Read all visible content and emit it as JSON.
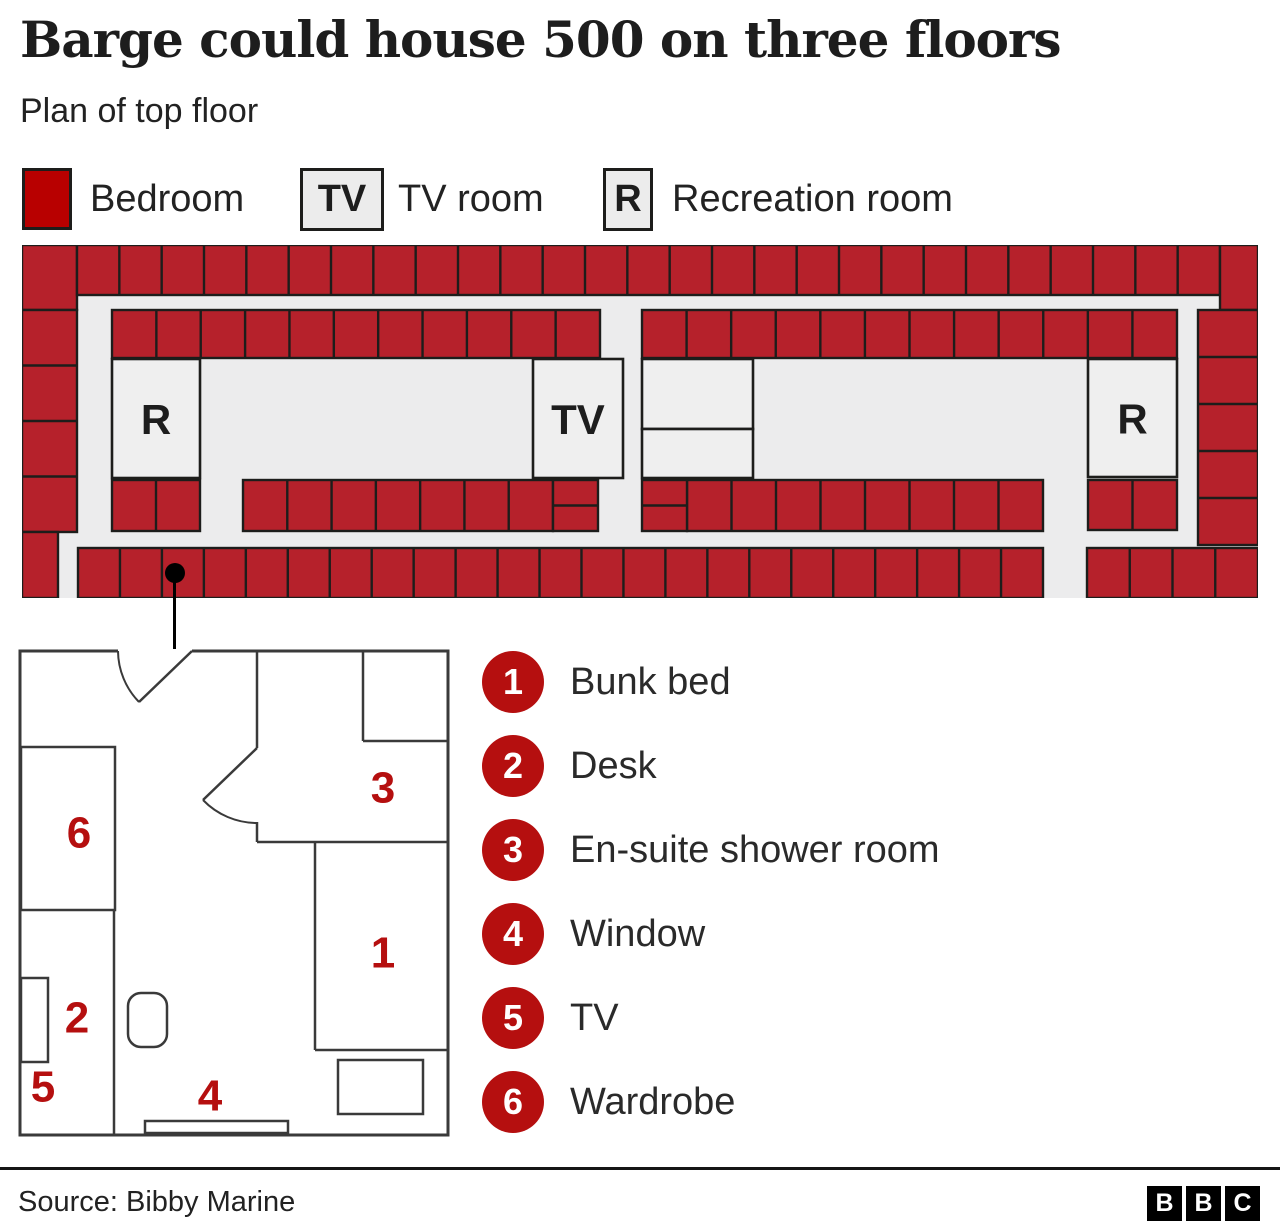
{
  "title": "Barge could house 500 on three floors",
  "subtitle": "Plan of top floor",
  "legend": {
    "bedroom_label": "Bedroom",
    "tv_box_label": "TV",
    "tv_room_label": "TV room",
    "r_box_label": "R",
    "recreation_label": "Recreation room"
  },
  "colors": {
    "swatch_red": "#b80000",
    "cell_red": "#b6212b",
    "accent_red": "#b50f0f",
    "cell_stroke": "#1d1d1b",
    "corridor_gray": "#ececed",
    "room_gray": "#efefef",
    "wall_gray": "#3a3a3a"
  },
  "floor_plan": {
    "width": 1236,
    "height": 353,
    "strips": [
      {
        "x": 0,
        "y": 0,
        "w": 55,
        "h": 65,
        "n": 1
      },
      {
        "x": 55,
        "y": 0,
        "w": 1143,
        "h": 50,
        "n": 27
      },
      {
        "x": 1198,
        "y": 0,
        "w": 38,
        "h": 65,
        "n": 1
      },
      {
        "x": 0,
        "y": 65,
        "w": 55,
        "h": 222,
        "n": 4,
        "dir": "v"
      },
      {
        "x": 1176,
        "y": 65,
        "w": 60,
        "h": 235,
        "n": 5,
        "dir": "v"
      },
      {
        "x": 90,
        "y": 65,
        "w": 488,
        "h": 48,
        "n": 11
      },
      {
        "x": 620,
        "y": 65,
        "w": 535,
        "h": 48,
        "n": 12
      },
      {
        "x": 90,
        "y": 235,
        "w": 88,
        "h": 51,
        "n": 2
      },
      {
        "x": 221,
        "y": 235,
        "w": 310,
        "h": 51,
        "n": 7
      },
      {
        "x": 665,
        "y": 235,
        "w": 356,
        "h": 51,
        "n": 8
      },
      {
        "x": 1066,
        "y": 235,
        "w": 89,
        "h": 50,
        "n": 2
      },
      {
        "x": 0,
        "y": 287,
        "w": 36,
        "h": 66,
        "n": 1
      },
      {
        "x": 56,
        "y": 303,
        "w": 965,
        "h": 50,
        "n": 23
      },
      {
        "x": 1065,
        "y": 303,
        "w": 171,
        "h": 50,
        "n": 4
      }
    ],
    "splits": [
      {
        "x": 531,
        "y": 235,
        "w": 45,
        "h": 51
      },
      {
        "x": 620,
        "y": 235,
        "w": 45,
        "h": 51
      }
    ],
    "rooms": [
      {
        "x": 90,
        "y": 114,
        "w": 88,
        "h": 119,
        "label": "R"
      },
      {
        "x": 511,
        "y": 114,
        "w": 90,
        "h": 119,
        "label": "TV"
      },
      {
        "x": 1066,
        "y": 114,
        "w": 89,
        "h": 118,
        "label": "R"
      },
      {
        "x": 620,
        "y": 114,
        "w": 111,
        "h": 70,
        "label": ""
      },
      {
        "x": 620,
        "y": 184,
        "w": 111,
        "h": 49,
        "label": ""
      }
    ],
    "marker": {
      "x": 153,
      "y": 328,
      "r": 10
    }
  },
  "room_detail": {
    "width": 432,
    "height": 488,
    "outer": {
      "x": 2,
      "y": 2,
      "w": 428,
      "h": 484
    },
    "top_gap": [
      100,
      2,
      174,
      2
    ],
    "walls": [
      [
        239,
        2,
        239,
        99
      ],
      [
        239,
        173,
        239,
        193
      ],
      [
        239,
        193,
        430,
        193
      ],
      [
        345,
        2,
        345,
        92
      ],
      [
        345,
        92,
        430,
        92
      ],
      [
        297,
        193,
        297,
        401
      ],
      [
        297,
        401,
        430,
        401
      ],
      [
        96,
        261,
        96,
        486
      ]
    ],
    "doors": [
      {
        "arc": "M 100 2 A 74 74 0 0 0 121 53",
        "leaf": [
          174,
          2,
          121,
          53
        ]
      },
      {
        "arc": "M 185 151 A 75 75 0 0 0 239 174",
        "leaf": [
          239,
          99,
          185,
          151
        ]
      }
    ],
    "fixtures": [
      {
        "x": 3,
        "y": 98,
        "w": 94,
        "h": 163
      },
      {
        "x": 3,
        "y": 329,
        "w": 27,
        "h": 84
      },
      {
        "x": 110,
        "y": 344,
        "w": 39,
        "h": 54,
        "rx": 13
      },
      {
        "x": 127,
        "y": 472,
        "w": 143,
        "h": 12
      },
      {
        "x": 320,
        "y": 411,
        "w": 85,
        "h": 54
      }
    ],
    "labels": [
      {
        "t": "1",
        "x": 365,
        "y": 304
      },
      {
        "t": "2",
        "x": 59,
        "y": 369
      },
      {
        "t": "3",
        "x": 365,
        "y": 139
      },
      {
        "t": "4",
        "x": 192,
        "y": 447
      },
      {
        "t": "5",
        "x": 25,
        "y": 438
      },
      {
        "t": "6",
        "x": 61,
        "y": 184
      }
    ]
  },
  "items": [
    {
      "num": "1",
      "label": "Bunk bed"
    },
    {
      "num": "2",
      "label": "Desk"
    },
    {
      "num": "3",
      "label": "En-suite shower room"
    },
    {
      "num": "4",
      "label": "Window"
    },
    {
      "num": "5",
      "label": "TV"
    },
    {
      "num": "6",
      "label": "Wardrobe"
    }
  ],
  "footer": {
    "source": "Source: Bibby Marine",
    "logo_letters": [
      "B",
      "B",
      "C"
    ]
  }
}
